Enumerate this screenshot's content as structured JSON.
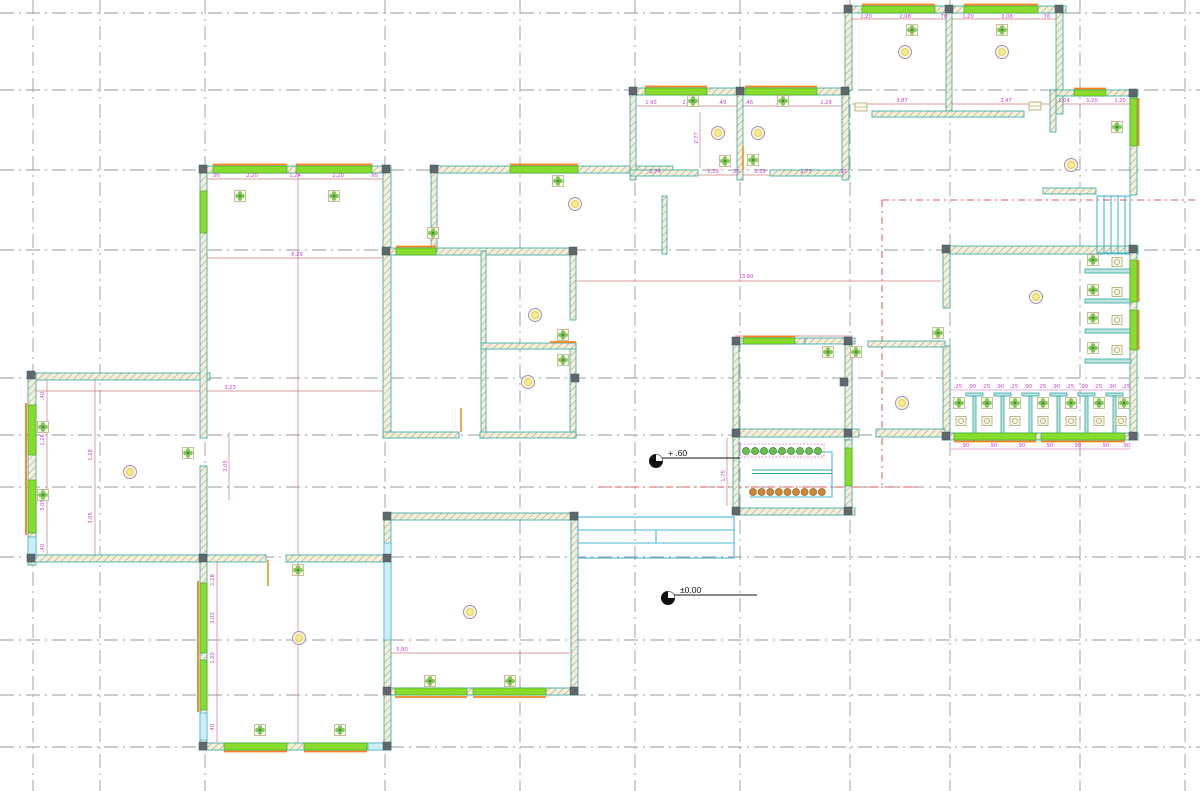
{
  "drawing": {
    "type": "architectural-floor-plan",
    "level_markers": [
      {
        "label": "+ .60",
        "cx": 656,
        "cy": 461,
        "x2": 740
      },
      {
        "label": "±0.00",
        "cx": 668,
        "cy": 598,
        "x2": 757
      }
    ]
  },
  "colors": {
    "wall_outline": "#2fa8a2",
    "wall_hatch": "#a09a6a",
    "window_green": "#86dd2e",
    "sill_orange": "#f5821f",
    "cyan": "#49b6d6",
    "dimension_line": "#cf7a7a",
    "dimension_text": "#cc3fcc",
    "grid_gray": "#969a9e",
    "roof_dashed": "#e05555",
    "fan_green": "#6fbf44",
    "lamp_fill": "#fdf6c8",
    "lamp_stroke": "#a08ed0",
    "fixture_olive": "#a9a873",
    "planter_green": "#6abf4b",
    "planter_brown": "#c9883a"
  },
  "grid": {
    "vertical_x": [
      33,
      100,
      205,
      385,
      520,
      635,
      740,
      850,
      950,
      1080,
      1185
    ],
    "horizontal_y": [
      13,
      90,
      170,
      250,
      378,
      435,
      487,
      557,
      640,
      695,
      747
    ]
  },
  "dimensions": [
    {
      "text": "1,20",
      "x": 866,
      "y": 18
    },
    {
      "text": "2,08",
      "x": 905,
      "y": 18
    },
    {
      "text": ".76",
      "x": 943,
      "y": 18
    },
    {
      "text": "1,20",
      "x": 968,
      "y": 18
    },
    {
      "text": "2,08",
      "x": 1007,
      "y": 18
    },
    {
      "text": ".76",
      "x": 1046,
      "y": 18
    },
    {
      "text": "3,87",
      "x": 902,
      "y": 102
    },
    {
      "text": "3,47",
      "x": 1006,
      "y": 102
    },
    {
      "text": "1,04",
      "x": 1064,
      "y": 102
    },
    {
      "text": "1,20",
      "x": 1092,
      "y": 102
    },
    {
      "text": "1,20",
      "x": 1120,
      "y": 102
    },
    {
      "text": "1,93",
      "x": 651,
      "y": 104
    },
    {
      "text": "2,07",
      "x": 688,
      "y": 104
    },
    {
      "text": ".49",
      "x": 722,
      "y": 104
    },
    {
      "text": ".46",
      "x": 749,
      "y": 104
    },
    {
      "text": "2,05",
      "x": 782,
      "y": 104
    },
    {
      "text": "1,29",
      "x": 826,
      "y": 104
    },
    {
      "text": "2,77",
      "x": 698,
      "y": 138,
      "rot": true
    },
    {
      "text": "2,74",
      "x": 655,
      "y": 173
    },
    {
      "text": "1,29",
      "x": 713,
      "y": 173
    },
    {
      "text": ".25",
      "x": 736,
      "y": 173
    },
    {
      "text": "1,29",
      "x": 760,
      "y": 173
    },
    {
      "text": "2,77",
      "x": 806,
      "y": 173
    },
    {
      "text": ".25",
      "x": 843,
      "y": 173
    },
    {
      "text": ".95",
      "x": 216,
      "y": 177
    },
    {
      "text": "2,20",
      "x": 252,
      "y": 177
    },
    {
      "text": "1,24",
      "x": 295,
      "y": 177
    },
    {
      "text": "2,20",
      "x": 338,
      "y": 177
    },
    {
      "text": ".95",
      "x": 374,
      "y": 177
    },
    {
      "text": "6,29",
      "x": 297,
      "y": 256
    },
    {
      "text": "13,80",
      "x": 746,
      "y": 278
    },
    {
      "text": "3,23",
      "x": 230,
      "y": 389
    },
    {
      "text": ".40",
      "x": 44,
      "y": 396,
      "rot": true
    },
    {
      "text": "1,28",
      "x": 44,
      "y": 440,
      "rot": true
    },
    {
      "text": "3,05",
      "x": 44,
      "y": 505,
      "rot": true
    },
    {
      "text": ".40",
      "x": 44,
      "y": 548,
      "rot": true
    },
    {
      "text": "1,28",
      "x": 92,
      "y": 455,
      "rot": true
    },
    {
      "text": "3,05",
      "x": 92,
      "y": 518,
      "rot": true
    },
    {
      "text": "3,05",
      "x": 227,
      "y": 466,
      "rot": true
    },
    {
      "text": "1,28",
      "x": 214,
      "y": 580,
      "rot": true
    },
    {
      "text": "3,03",
      "x": 214,
      "y": 618,
      "rot": true
    },
    {
      "text": "1,20",
      "x": 214,
      "y": 658,
      "rot": true
    },
    {
      "text": ".40",
      "x": 214,
      "y": 728,
      "rot": true
    },
    {
      "text": "5,90",
      "x": 402,
      "y": 651
    },
    {
      "text": "1,75",
      "x": 725,
      "y": 476,
      "rot": true
    },
    {
      "text": ".25",
      "x": 958,
      "y": 388
    },
    {
      "text": ".90",
      "x": 972,
      "y": 388
    },
    {
      "text": ".25",
      "x": 986,
      "y": 388
    },
    {
      "text": ".90",
      "x": 1000,
      "y": 388
    },
    {
      "text": ".25",
      "x": 1014,
      "y": 388
    },
    {
      "text": ".90",
      "x": 1028,
      "y": 388
    },
    {
      "text": ".25",
      "x": 1042,
      "y": 388
    },
    {
      "text": ".90",
      "x": 1056,
      "y": 388
    },
    {
      "text": ".25",
      "x": 1070,
      "y": 388
    },
    {
      "text": ".90",
      "x": 1084,
      "y": 388
    },
    {
      "text": ".25",
      "x": 1098,
      "y": 388
    },
    {
      "text": ".90",
      "x": 1112,
      "y": 388
    },
    {
      "text": ".25",
      "x": 1126,
      "y": 388
    },
    {
      "text": ".90",
      "x": 965,
      "y": 447
    },
    {
      "text": ".90",
      "x": 993,
      "y": 447
    },
    {
      "text": ".90",
      "x": 1021,
      "y": 447
    },
    {
      "text": ".90",
      "x": 1049,
      "y": 447
    },
    {
      "text": ".90",
      "x": 1077,
      "y": 447
    },
    {
      "text": ".90",
      "x": 1105,
      "y": 447
    },
    {
      "text": ".90",
      "x": 1126,
      "y": 447
    }
  ],
  "symbols": {
    "fans": [
      [
        240,
        196
      ],
      [
        334,
        196
      ],
      [
        433,
        233
      ],
      [
        558,
        181
      ],
      [
        563,
        335
      ],
      [
        563,
        360
      ],
      [
        43,
        427
      ],
      [
        43,
        495
      ],
      [
        188,
        453
      ],
      [
        298,
        570
      ],
      [
        260,
        730
      ],
      [
        340,
        730
      ],
      [
        430,
        681
      ],
      [
        510,
        681
      ],
      [
        693,
        101
      ],
      [
        783,
        101
      ],
      [
        725,
        161
      ],
      [
        753,
        160
      ],
      [
        912,
        30
      ],
      [
        1002,
        30
      ],
      [
        1117,
        127
      ],
      [
        938,
        333
      ],
      [
        828,
        352
      ],
      [
        856,
        352
      ],
      [
        959,
        403
      ],
      [
        987,
        403
      ],
      [
        1015,
        403
      ],
      [
        1043,
        403
      ],
      [
        1071,
        403
      ],
      [
        1099,
        403
      ],
      [
        1124,
        403
      ],
      [
        1093,
        260
      ],
      [
        1093,
        290
      ],
      [
        1093,
        318
      ],
      [
        1093,
        348
      ]
    ],
    "lamps": [
      [
        905,
        52
      ],
      [
        1002,
        52
      ],
      [
        718,
        133
      ],
      [
        758,
        133
      ],
      [
        575,
        204
      ],
      [
        535,
        315
      ],
      [
        528,
        382
      ],
      [
        130,
        472
      ],
      [
        299,
        638
      ],
      [
        470,
        612
      ],
      [
        1071,
        165
      ],
      [
        1036,
        297
      ],
      [
        902,
        403
      ]
    ],
    "wc": [
      [
        961,
        421
      ],
      [
        987,
        421
      ],
      [
        1015,
        421
      ],
      [
        1043,
        421
      ],
      [
        1071,
        421
      ],
      [
        1099,
        421
      ],
      [
        1121,
        421
      ],
      [
        1117,
        262
      ],
      [
        1117,
        292
      ],
      [
        1117,
        320
      ],
      [
        1117,
        350
      ]
    ],
    "boxes": [
      [
        861,
        107
      ],
      [
        1035,
        106
      ]
    ]
  },
  "planter": {
    "green_row": {
      "x0": 746,
      "y": 451,
      "step": 9,
      "count": 9,
      "r": 3.5
    },
    "brown_row": {
      "x0": 753,
      "y": 492,
      "step": 8.6,
      "count": 9,
      "r": 3.5
    }
  }
}
